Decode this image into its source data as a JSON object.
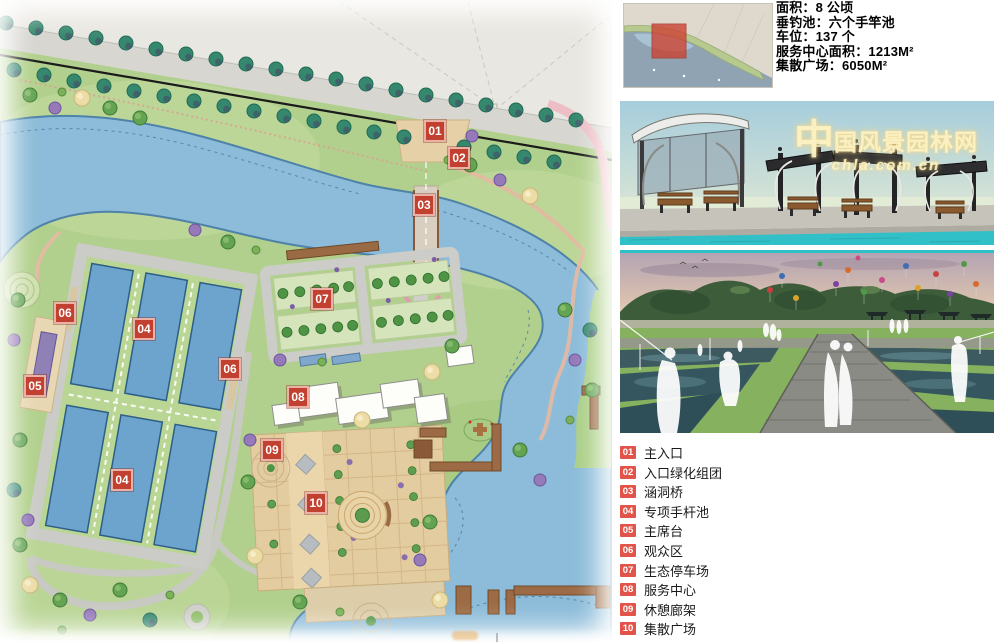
{
  "stats": {
    "lines": [
      "面积：8 公顷",
      "垂钓池：六个手竿池",
      "车位：137 个",
      "服务中心面积：1213M²",
      "集散广场：6050M²"
    ]
  },
  "legend": {
    "items": [
      {
        "num": "01",
        "label": "主入口"
      },
      {
        "num": "02",
        "label": "入口绿化组团"
      },
      {
        "num": "03",
        "label": "涵洞桥"
      },
      {
        "num": "04",
        "label": "专项手杆池"
      },
      {
        "num": "05",
        "label": "主席台"
      },
      {
        "num": "06",
        "label": "观众区"
      },
      {
        "num": "07",
        "label": "生态停车场"
      },
      {
        "num": "08",
        "label": "服务中心"
      },
      {
        "num": "09",
        "label": "休憩廊架"
      },
      {
        "num": "10",
        "label": "集散广场"
      }
    ]
  },
  "plan": {
    "markers": [
      {
        "num": "01",
        "x": 435,
        "y": 131
      },
      {
        "num": "02",
        "x": 459,
        "y": 158
      },
      {
        "num": "03",
        "x": 424,
        "y": 205
      },
      {
        "num": "04",
        "x": 144,
        "y": 329
      },
      {
        "num": "04",
        "x": 122,
        "y": 480
      },
      {
        "num": "05",
        "x": 35,
        "y": 386
      },
      {
        "num": "06",
        "x": 65,
        "y": 313
      },
      {
        "num": "06",
        "x": 230,
        "y": 369
      },
      {
        "num": "07",
        "x": 322,
        "y": 299
      },
      {
        "num": "08",
        "x": 298,
        "y": 397
      },
      {
        "num": "09",
        "x": 272,
        "y": 450
      },
      {
        "num": "10",
        "x": 316,
        "y": 503
      }
    ]
  },
  "watermark": {
    "logo": "中",
    "title": "国风景园林网",
    "url": "chla.com.cn"
  },
  "colors": {
    "marker_red": "#c2402f",
    "legend_red": "#e2544a",
    "water": "#8cbcd9",
    "pond_blue": "#6ca4ce"
  }
}
